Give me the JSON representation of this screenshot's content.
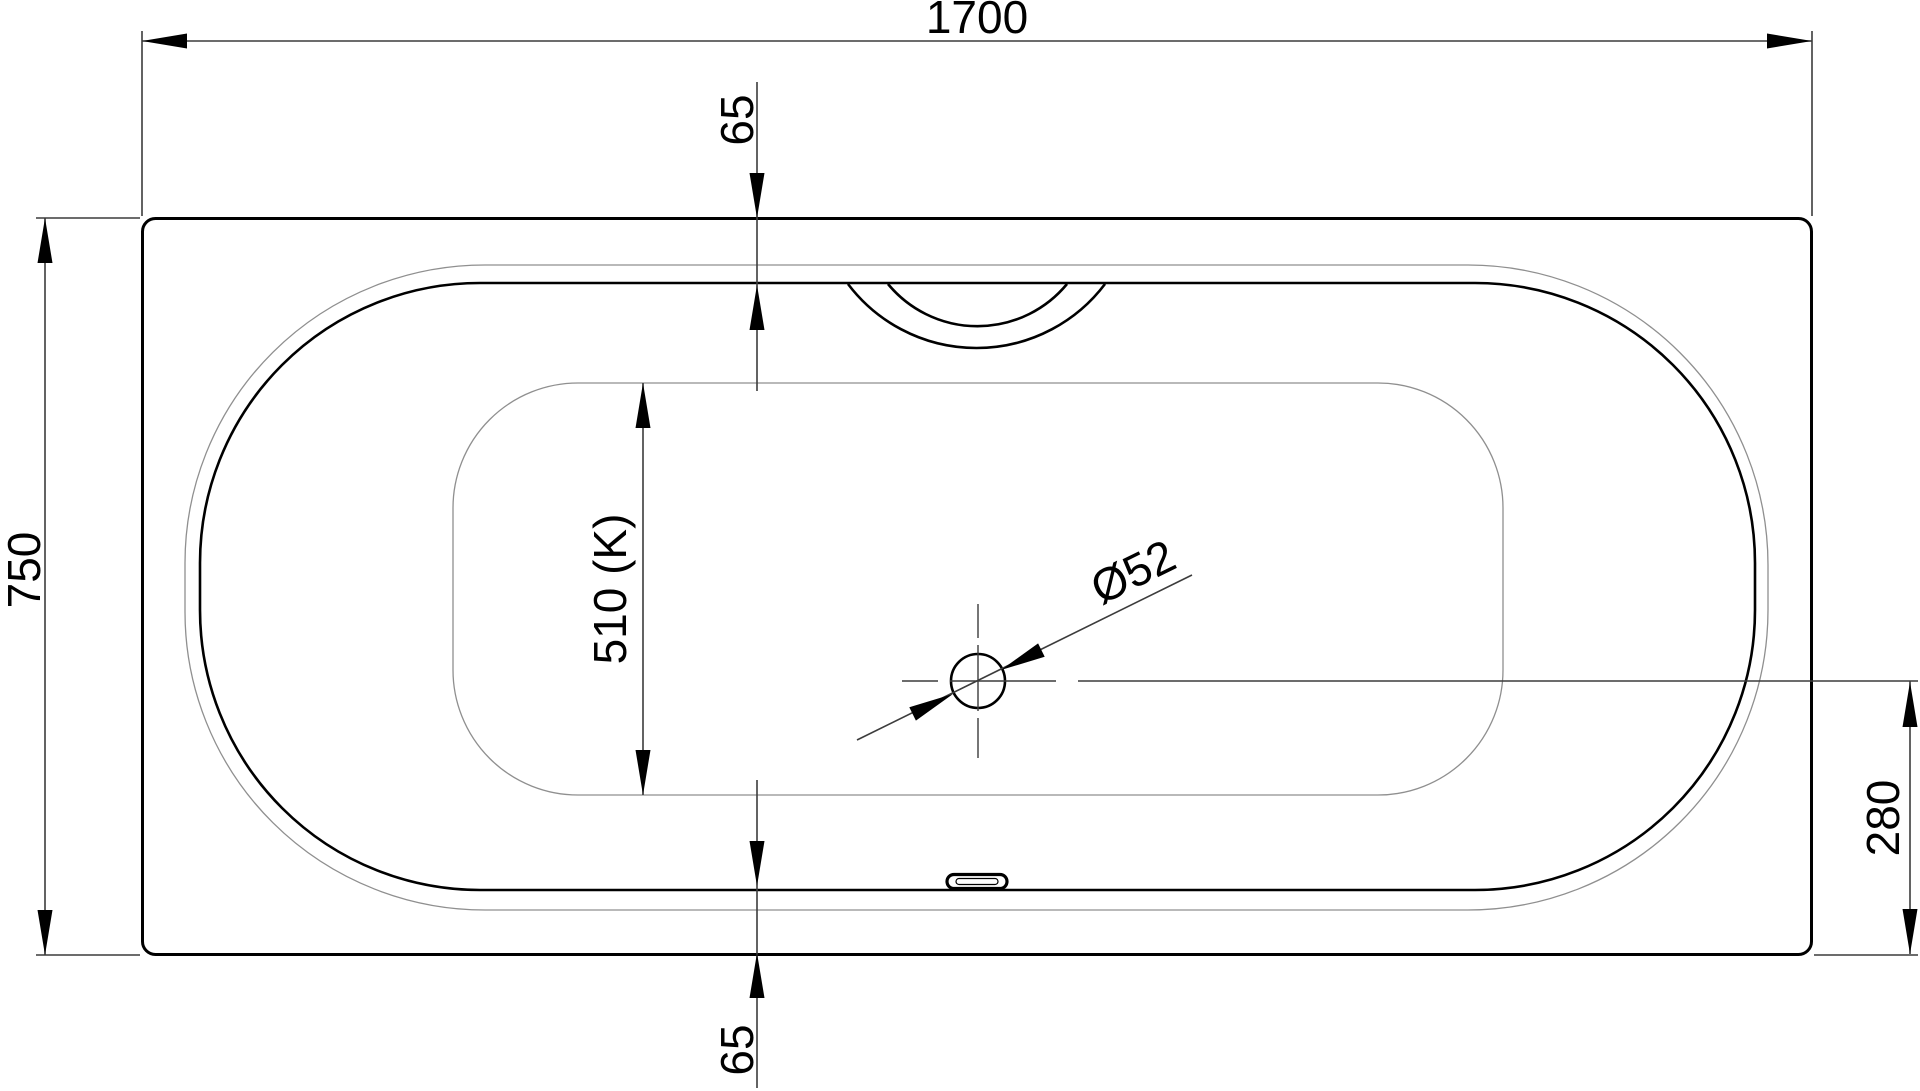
{
  "drawing": {
    "dimensions": {
      "overall_length": {
        "label": "1700"
      },
      "overall_width": {
        "label": "750"
      },
      "rim_top": {
        "label": "65"
      },
      "rim_bottom": {
        "label": "65"
      },
      "floor_width": {
        "label": "510 (K)"
      },
      "drain_diameter": {
        "label": "Ø52"
      },
      "drain_offset": {
        "label": "280"
      }
    },
    "colors": {
      "background": "#ffffff",
      "main_outline": "#000000",
      "thin_contour": "#8f8f8f",
      "dimension_lines": "#3c3c3c",
      "text": "#000000"
    }
  }
}
